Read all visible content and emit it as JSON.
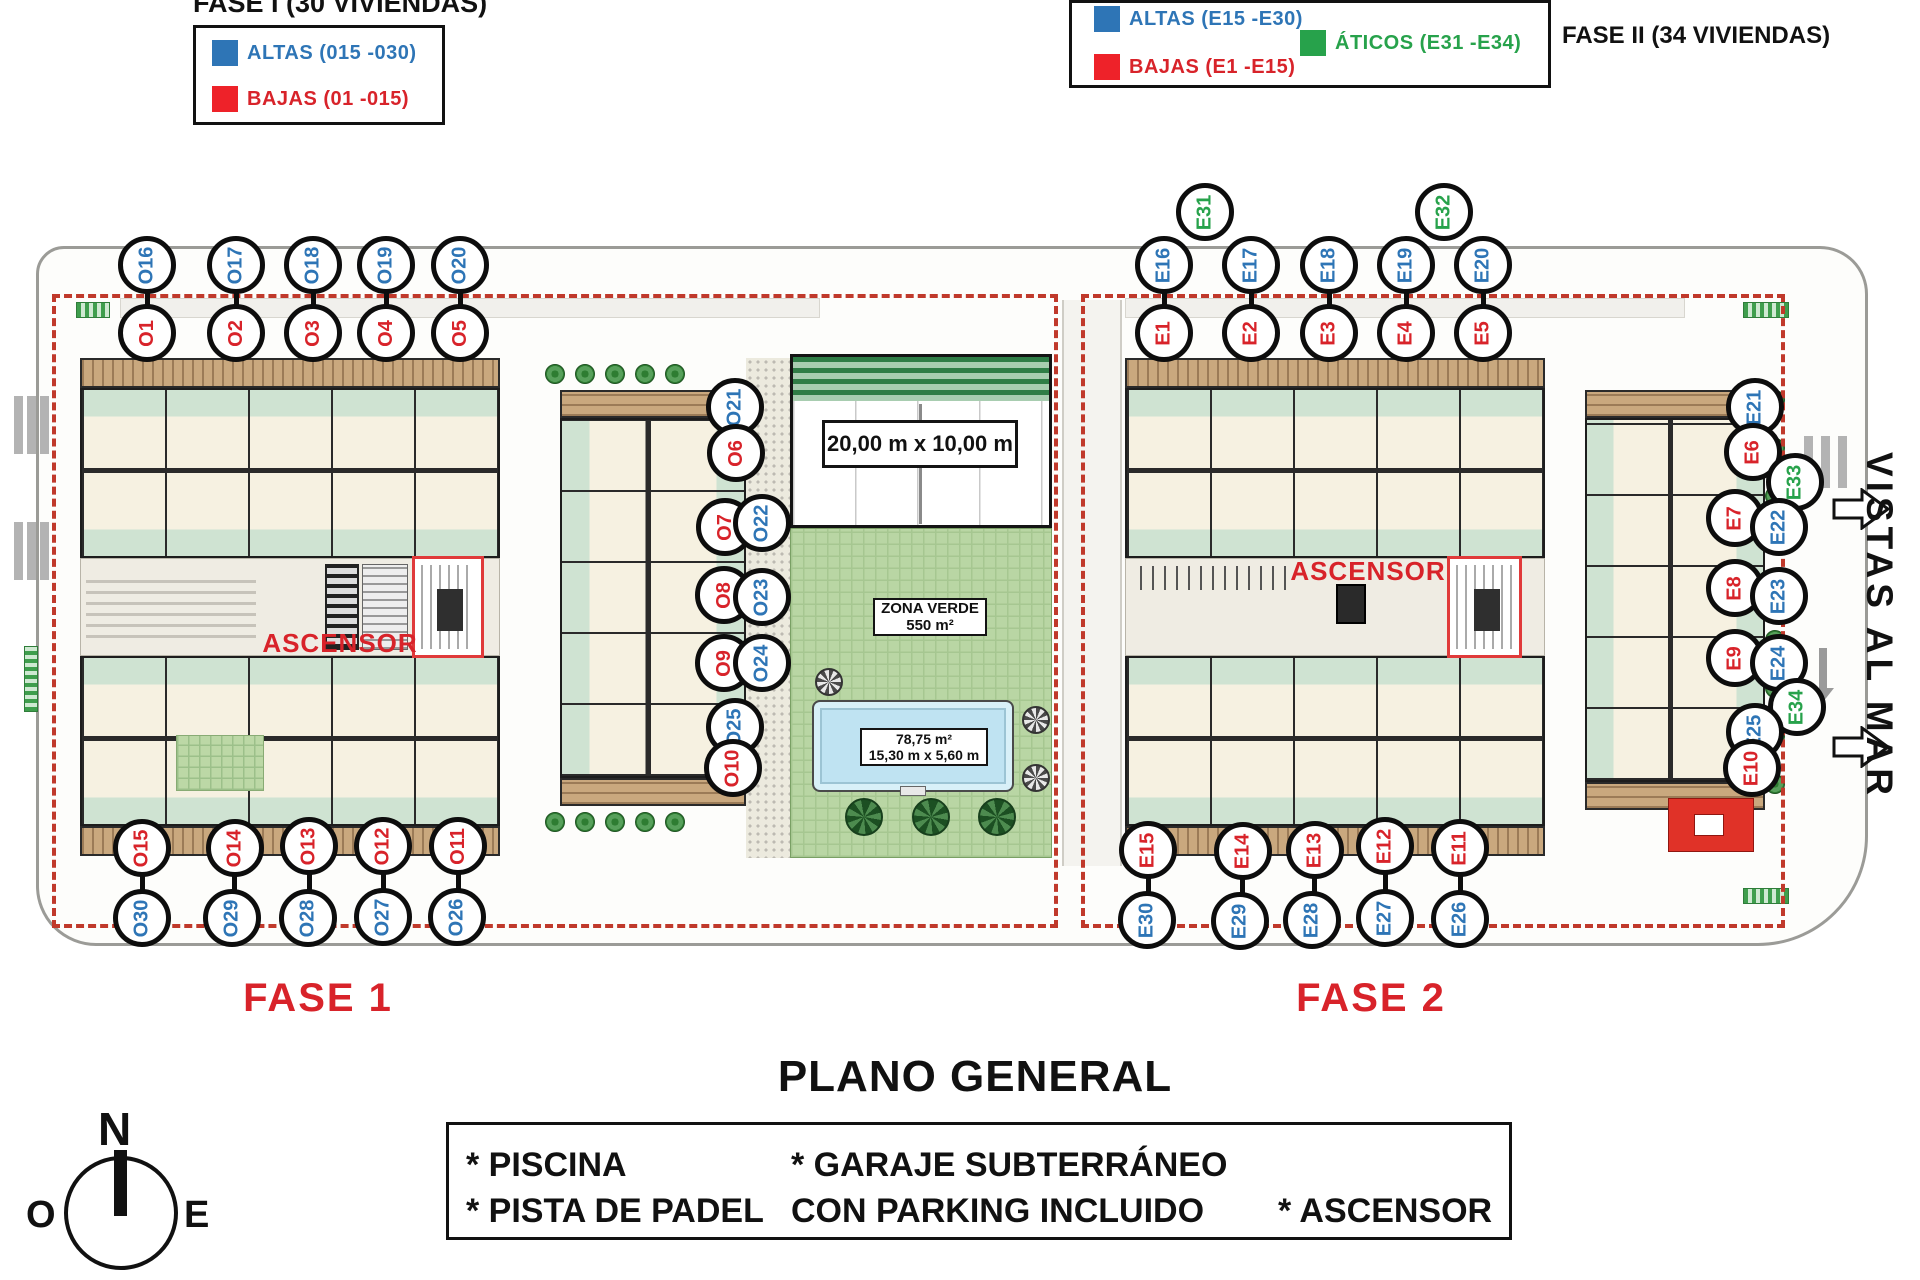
{
  "colors": {
    "blue": "#2e75b6",
    "red": "#d8232a",
    "green": "#27a24b",
    "dashed_boundary": "#c0392b"
  },
  "legend_fase1": {
    "title": "FASE I (30 VIVIENDAS)",
    "items": [
      {
        "key": "altas",
        "label": "ALTAS (015 -030)",
        "color": "blue"
      },
      {
        "key": "bajas",
        "label": "BAJAS (01 -015)",
        "color": "red"
      }
    ]
  },
  "legend_fase2": {
    "title": "FASE II (34 VIVIENDAS)",
    "items": [
      {
        "key": "altas",
        "label": "ALTAS (E15 -E30)",
        "color": "blue"
      },
      {
        "key": "bajas",
        "label": "BAJAS (E1 -E15)",
        "color": "red"
      },
      {
        "key": "aticos",
        "label": "ÁTICOS (E31 -E34)",
        "color": "green"
      }
    ]
  },
  "plan": {
    "fase1_label": "FASE 1",
    "fase2_label": "FASE 2",
    "ascensor1": "ASCENSOR",
    "ascensor2": "ASCENSOR",
    "padel_dimensions": "20,00 m x 10,00 m",
    "zona_verde": {
      "line1": "ZONA VERDE",
      "line2": "550 m²"
    },
    "pool": {
      "line1": "78,75 m²",
      "line2": "15,30 m x 5,60 m"
    },
    "vistas_al_mar": "VISTAS AL MAR"
  },
  "footer": {
    "title": "PLANO GENERAL",
    "amenities": {
      "piscina": "* PISCINA",
      "pista": "* PISTA DE PADEL",
      "garaje": "* GARAJE SUBTERRÁNEO",
      "parking": "CON PARKING INCLUIDO",
      "ascensor": "* ASCENSOR"
    }
  },
  "compass": {
    "north": "N",
    "east": "E",
    "west": "O"
  },
  "markers": [
    {
      "id": "O16",
      "color": "blue",
      "x": 147,
      "y": 265
    },
    {
      "id": "O17",
      "color": "blue",
      "x": 236,
      "y": 265
    },
    {
      "id": "O18",
      "color": "blue",
      "x": 313,
      "y": 265
    },
    {
      "id": "O19",
      "color": "blue",
      "x": 386,
      "y": 265
    },
    {
      "id": "O20",
      "color": "blue",
      "x": 460,
      "y": 265
    },
    {
      "id": "O1",
      "color": "red",
      "x": 147,
      "y": 333
    },
    {
      "id": "O2",
      "color": "red",
      "x": 236,
      "y": 333
    },
    {
      "id": "O3",
      "color": "red",
      "x": 313,
      "y": 333
    },
    {
      "id": "O4",
      "color": "red",
      "x": 386,
      "y": 333
    },
    {
      "id": "O5",
      "color": "red",
      "x": 460,
      "y": 333
    },
    {
      "id": "E31",
      "color": "green",
      "x": 1205,
      "y": 212
    },
    {
      "id": "E32",
      "color": "green",
      "x": 1444,
      "y": 212
    },
    {
      "id": "E16",
      "color": "blue",
      "x": 1164,
      "y": 265
    },
    {
      "id": "E17",
      "color": "blue",
      "x": 1251,
      "y": 265
    },
    {
      "id": "E18",
      "color": "blue",
      "x": 1329,
      "y": 265
    },
    {
      "id": "E19",
      "color": "blue",
      "x": 1406,
      "y": 265
    },
    {
      "id": "E20",
      "color": "blue",
      "x": 1483,
      "y": 265
    },
    {
      "id": "E1",
      "color": "red",
      "x": 1164,
      "y": 333
    },
    {
      "id": "E2",
      "color": "red",
      "x": 1251,
      "y": 333
    },
    {
      "id": "E3",
      "color": "red",
      "x": 1329,
      "y": 333
    },
    {
      "id": "E4",
      "color": "red",
      "x": 1406,
      "y": 333
    },
    {
      "id": "E5",
      "color": "red",
      "x": 1483,
      "y": 333
    },
    {
      "id": "O21",
      "color": "blue",
      "x": 735,
      "y": 407
    },
    {
      "id": "O6",
      "color": "red",
      "x": 736,
      "y": 453
    },
    {
      "id": "O7",
      "color": "red",
      "x": 725,
      "y": 527
    },
    {
      "id": "O22",
      "color": "blue",
      "x": 762,
      "y": 523
    },
    {
      "id": "O8",
      "color": "red",
      "x": 724,
      "y": 595
    },
    {
      "id": "O23",
      "color": "blue",
      "x": 762,
      "y": 597
    },
    {
      "id": "O9",
      "color": "red",
      "x": 724,
      "y": 663
    },
    {
      "id": "O24",
      "color": "blue",
      "x": 762,
      "y": 663
    },
    {
      "id": "O25",
      "color": "blue",
      "x": 735,
      "y": 727
    },
    {
      "id": "O10",
      "color": "red",
      "x": 733,
      "y": 768
    },
    {
      "id": "E21",
      "color": "blue",
      "x": 1755,
      "y": 407
    },
    {
      "id": "E6",
      "color": "red",
      "x": 1753,
      "y": 452
    },
    {
      "id": "E33",
      "color": "green",
      "x": 1795,
      "y": 482
    },
    {
      "id": "E7",
      "color": "red",
      "x": 1735,
      "y": 518
    },
    {
      "id": "E22",
      "color": "blue",
      "x": 1779,
      "y": 527
    },
    {
      "id": "E8",
      "color": "red",
      "x": 1735,
      "y": 588
    },
    {
      "id": "E23",
      "color": "blue",
      "x": 1779,
      "y": 596
    },
    {
      "id": "E9",
      "color": "red",
      "x": 1735,
      "y": 658
    },
    {
      "id": "E24",
      "color": "blue",
      "x": 1779,
      "y": 663
    },
    {
      "id": "E34",
      "color": "green",
      "x": 1797,
      "y": 707
    },
    {
      "id": "E25",
      "color": "blue",
      "x": 1755,
      "y": 732
    },
    {
      "id": "E10",
      "color": "red",
      "x": 1752,
      "y": 768
    },
    {
      "id": "O15",
      "color": "red",
      "x": 142,
      "y": 848
    },
    {
      "id": "O14",
      "color": "red",
      "x": 235,
      "y": 848
    },
    {
      "id": "O13",
      "color": "red",
      "x": 309,
      "y": 846
    },
    {
      "id": "O12",
      "color": "red",
      "x": 383,
      "y": 846
    },
    {
      "id": "O11",
      "color": "red",
      "x": 458,
      "y": 846
    },
    {
      "id": "O30",
      "color": "blue",
      "x": 142,
      "y": 918
    },
    {
      "id": "O29",
      "color": "blue",
      "x": 232,
      "y": 918
    },
    {
      "id": "O28",
      "color": "blue",
      "x": 308,
      "y": 918
    },
    {
      "id": "O27",
      "color": "blue",
      "x": 383,
      "y": 917
    },
    {
      "id": "O26",
      "color": "blue",
      "x": 457,
      "y": 917
    },
    {
      "id": "E15",
      "color": "red",
      "x": 1148,
      "y": 850
    },
    {
      "id": "E14",
      "color": "red",
      "x": 1243,
      "y": 851
    },
    {
      "id": "E13",
      "color": "red",
      "x": 1315,
      "y": 850
    },
    {
      "id": "E12",
      "color": "red",
      "x": 1385,
      "y": 846
    },
    {
      "id": "E11",
      "color": "red",
      "x": 1460,
      "y": 848
    },
    {
      "id": "E30",
      "color": "blue",
      "x": 1147,
      "y": 920
    },
    {
      "id": "E29",
      "color": "blue",
      "x": 1240,
      "y": 921
    },
    {
      "id": "E28",
      "color": "blue",
      "x": 1312,
      "y": 920
    },
    {
      "id": "E27",
      "color": "blue",
      "x": 1385,
      "y": 918
    },
    {
      "id": "E26",
      "color": "blue",
      "x": 1460,
      "y": 919
    }
  ],
  "connector_pairs": [
    [
      "O16",
      "O1"
    ],
    [
      "O17",
      "O2"
    ],
    [
      "O18",
      "O3"
    ],
    [
      "O19",
      "O4"
    ],
    [
      "O20",
      "O5"
    ],
    [
      "E16",
      "E1"
    ],
    [
      "E17",
      "E2"
    ],
    [
      "E18",
      "E3"
    ],
    [
      "E19",
      "E4"
    ],
    [
      "E20",
      "E5"
    ],
    [
      "O15",
      "O30"
    ],
    [
      "O14",
      "O29"
    ],
    [
      "O13",
      "O28"
    ],
    [
      "O12",
      "O27"
    ],
    [
      "O11",
      "O26"
    ],
    [
      "E15",
      "E30"
    ],
    [
      "E14",
      "E29"
    ],
    [
      "E13",
      "E28"
    ],
    [
      "E12",
      "E27"
    ],
    [
      "E11",
      "E26"
    ]
  ]
}
